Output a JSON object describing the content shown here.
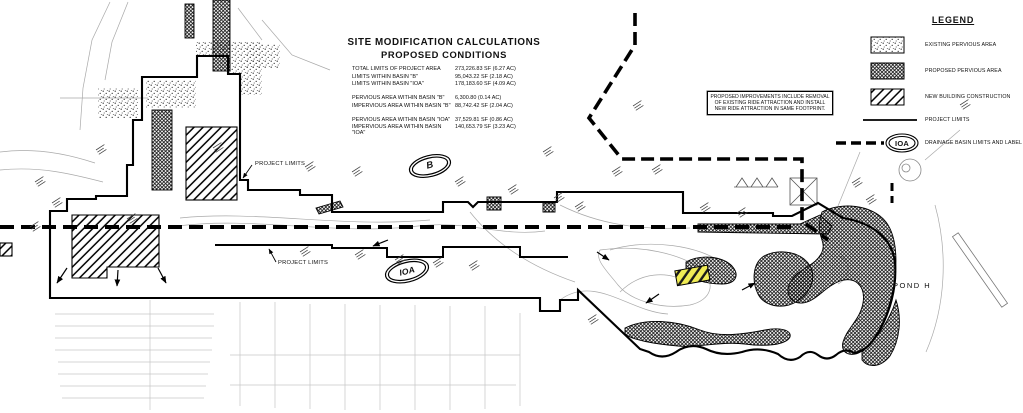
{
  "drawing_title": {
    "line1": "SITE MODIFICATION CALCULATIONS",
    "line2": "PROPOSED CONDITIONS"
  },
  "calculations": {
    "rows": [
      {
        "label": "TOTAL LIMITS OF PROJECT AREA",
        "value": "273,226.83 SF (6.27 AC)"
      },
      {
        "label": "LIMITS WITHIN BASIN \"B\"",
        "value": "95,043.22 SF (2.18 AC)"
      },
      {
        "label": "LIMITS WITHIN BASIN \"IOA\"",
        "value": "178,183.60 SF (4.09 AC)"
      },
      {
        "label": "PERVIOUS AREA WITHIN BASIN \"B\"",
        "value": "6,300.80 (0.14 AC)"
      },
      {
        "label": "IMPERVIOUS AREA WITHIN BASIN \"B\"",
        "value": "88,742.42 SF (2.04 AC)"
      },
      {
        "label": "PERVIOUS AREA WITHIN BASIN \"IOA\"",
        "value": "37,529.81 SF (0.86 AC)"
      },
      {
        "label": "IMPERVIOUS AREA WITHIN BASIN \"IOA\"",
        "value": "140,653.79 SF (3.23 AC)"
      }
    ]
  },
  "note_box": {
    "line1": "PROPOSED IMPROVEMENTS INCLUDE REMOVAL",
    "line2": "OF EXISTING RIDE ATTRACTION AND INSTALL",
    "line3": "NEW RIDE ATTRACTION IN SAME FOOTPRINT."
  },
  "legend": {
    "title": "LEGEND",
    "items": [
      {
        "label": "EXISTING PERVIOUS AREA",
        "swatch": "stipple"
      },
      {
        "label": "PROPOSED PERVIOUS AREA",
        "swatch": "crosshatch"
      },
      {
        "label": "NEW BUILDING CONSTRUCTION",
        "swatch": "diagonal-hatch"
      },
      {
        "label": "PROJECT LIMITS",
        "swatch": "solid-line"
      },
      {
        "label": "DRAINAGE BASIN LIMITS AND LABEL",
        "swatch": "dashed-line-with-oval",
        "oval_label": "IOA"
      }
    ]
  },
  "map_labels": {
    "project_limits_upper": "PROJECT LIMITS",
    "project_limits_lower": "PROJECT LIMITS",
    "basin_b": "B",
    "basin_ioa": "IOA",
    "pond": "POND H"
  },
  "colors": {
    "ride_highlight": "#f0ec55",
    "line_color": "#000000"
  }
}
